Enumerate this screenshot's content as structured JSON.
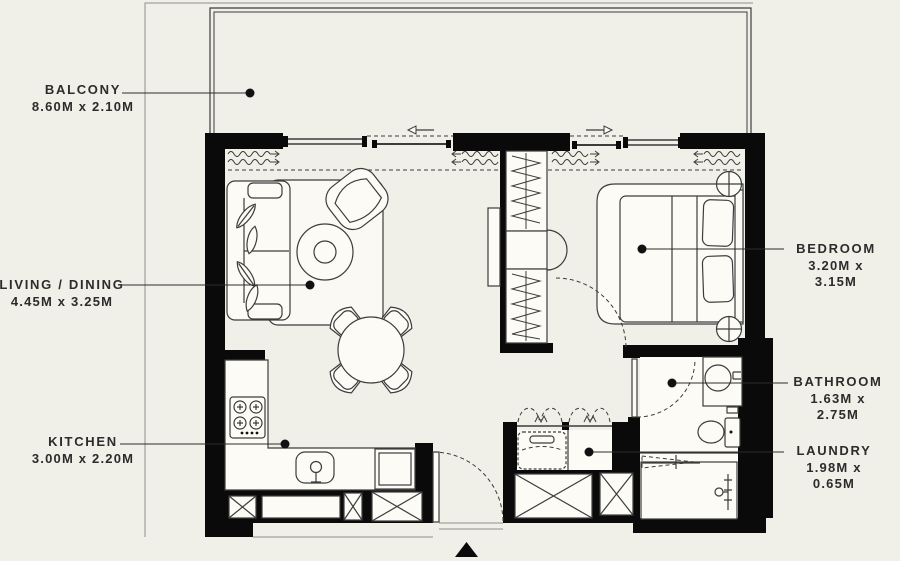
{
  "floor_plan": {
    "background_color": "#f0efe8",
    "wall_color": "#0a0a0a",
    "line_color": "#3c3c3c",
    "rooms": [
      {
        "id": "balcony",
        "label": "BALCONY",
        "dimensions": "8.60M x 2.10M"
      },
      {
        "id": "living-dining",
        "label": "LIVING / DINING",
        "dimensions": "4.45M x 3.25M"
      },
      {
        "id": "kitchen",
        "label": "KITCHEN",
        "dimensions": "3.00M x 2.20M"
      },
      {
        "id": "bedroom",
        "label": "BEDROOM",
        "dimensions": "3.20M x 3.15M"
      },
      {
        "id": "bathroom",
        "label": "BATHROOM",
        "dimensions": "1.63M x 2.75M"
      },
      {
        "id": "laundry",
        "label": "LAUNDRY",
        "dimensions": "1.98M x 0.65M"
      }
    ]
  }
}
